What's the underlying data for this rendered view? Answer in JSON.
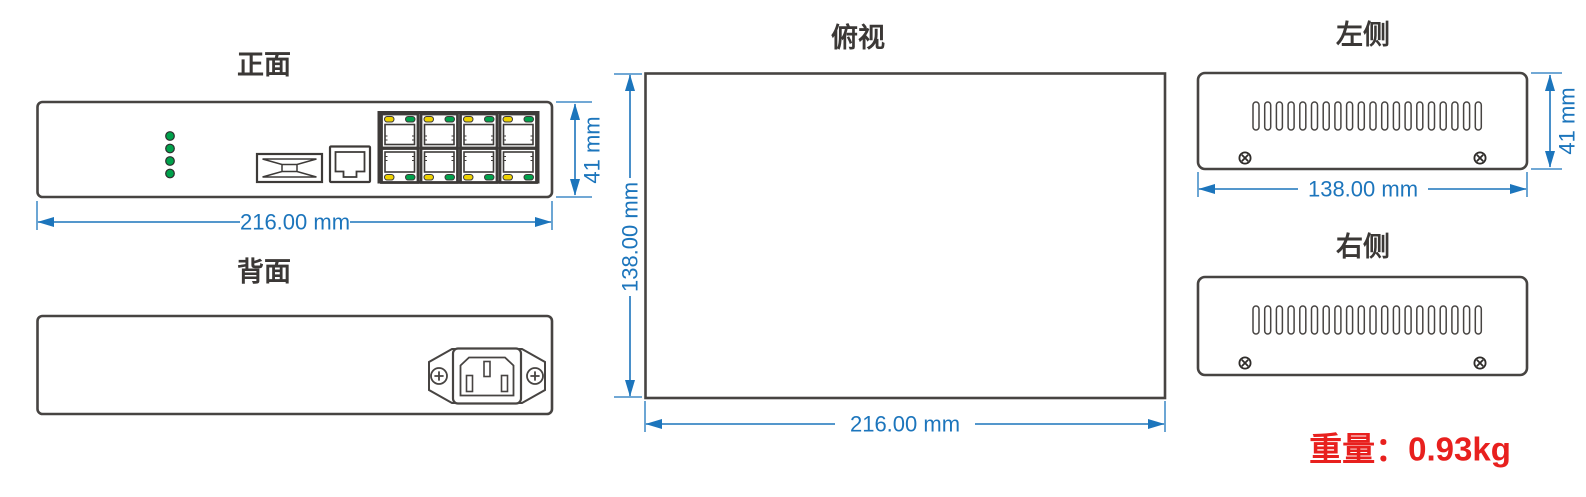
{
  "drawing": {
    "front": {
      "title": "正面",
      "width": "216.00 mm",
      "height": "41 mm"
    },
    "back": {
      "title": "背面"
    },
    "top": {
      "title": "俯视",
      "width": "216.00 mm",
      "depth": "138.00 mm"
    },
    "left": {
      "title": "左侧",
      "width": "138.00 mm",
      "height": "41 mm"
    },
    "right": {
      "title": "右侧"
    },
    "weight": "重量：0.93kg"
  },
  "icons": {
    "status_leds": "four-green-led-indicators",
    "sfp_port": "sfp-fiber-cage",
    "console_port": "single-rj45-jack",
    "rj45_block": "eight-rj45-ports-with-yellow-green-leds",
    "power_inlet": "iec-c14-power-socket",
    "screws": "cross-head-screws",
    "vents": "ventilation-slots"
  },
  "colors": {
    "outline_gray": "#474442",
    "dimension_blue": "#1c75bc",
    "led_green": "#00a14b",
    "led_yellow": "#eed202",
    "weight_red": "#e8201e"
  }
}
